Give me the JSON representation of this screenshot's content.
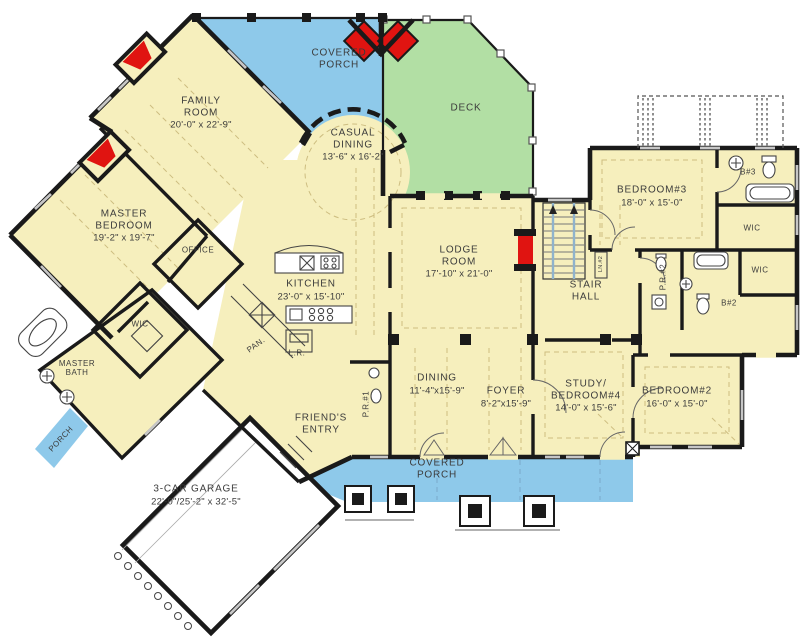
{
  "plan": {
    "colors": {
      "room": "#f6efbd",
      "porch": "#8ec9ea",
      "deck": "#b2dfa4",
      "fireplace": "#e01411",
      "garage": "#ffffff",
      "wall": "#1a1a1a"
    },
    "rooms": [
      {
        "id": "family-room",
        "name": "FAMILY\nROOM",
        "dims": "20'-0\" x 22'-9\""
      },
      {
        "id": "covered-porch-top",
        "name": "COVERED\nPORCH"
      },
      {
        "id": "deck",
        "name": "DECK"
      },
      {
        "id": "casual-dining",
        "name": "CASUAL\nDINING",
        "dims": "13'-6\" x 16'-2\""
      },
      {
        "id": "master-bedroom",
        "name": "MASTER\nBEDROOM",
        "dims": "19'-2\" x 19'-7\""
      },
      {
        "id": "office",
        "name": "OFFICE"
      },
      {
        "id": "kitchen",
        "name": "KITCHEN",
        "dims": "23'-0\" x 15'-10\""
      },
      {
        "id": "lodge-room",
        "name": "LODGE\nROOM",
        "dims": "17'-10\" x 21'-0\""
      },
      {
        "id": "stair-hall",
        "name": "STAIR\nHALL"
      },
      {
        "id": "bedroom-3",
        "name": "BEDROOM#3",
        "dims": "18'-0\" x 15'-0\""
      },
      {
        "id": "bath-3",
        "name": "B#3"
      },
      {
        "id": "wic-bedroom-3",
        "name": "WIC"
      },
      {
        "id": "powder-room-2",
        "name": "P.R.#2"
      },
      {
        "id": "linen-2",
        "name": "LN.#2"
      },
      {
        "id": "wic-bedroom-2",
        "name": "WIC"
      },
      {
        "id": "bath-2",
        "name": "B#2"
      },
      {
        "id": "wic-master",
        "name": "WIC"
      },
      {
        "id": "master-bath",
        "name": "MASTER\nBATH"
      },
      {
        "id": "pantry",
        "name": "PAN."
      },
      {
        "id": "laundry",
        "name": "L.R."
      },
      {
        "id": "powder-room-1",
        "name": "P.R.#1"
      },
      {
        "id": "friends-entry",
        "name": "FRIEND'S\nENTRY"
      },
      {
        "id": "dining",
        "name": "DINING",
        "dims": "11'-4\"x15'-9\""
      },
      {
        "id": "foyer",
        "name": "FOYER",
        "dims": "8'-2\"x15'-9\""
      },
      {
        "id": "study-bedroom-4",
        "name": "STUDY/\nBEDROOM#4",
        "dims": "14'-0\" x 15'-6\""
      },
      {
        "id": "bedroom-2",
        "name": "BEDROOM#2",
        "dims": "16'-0\" x 15'-0\""
      },
      {
        "id": "covered-porch-bottom",
        "name": "COVERED\nPORCH"
      },
      {
        "id": "porch-side",
        "name": "PORCH"
      },
      {
        "id": "garage",
        "name": "3-CAR GARAGE",
        "dims": "22'-0\"/25'-2\" x 32'-5\""
      }
    ]
  }
}
